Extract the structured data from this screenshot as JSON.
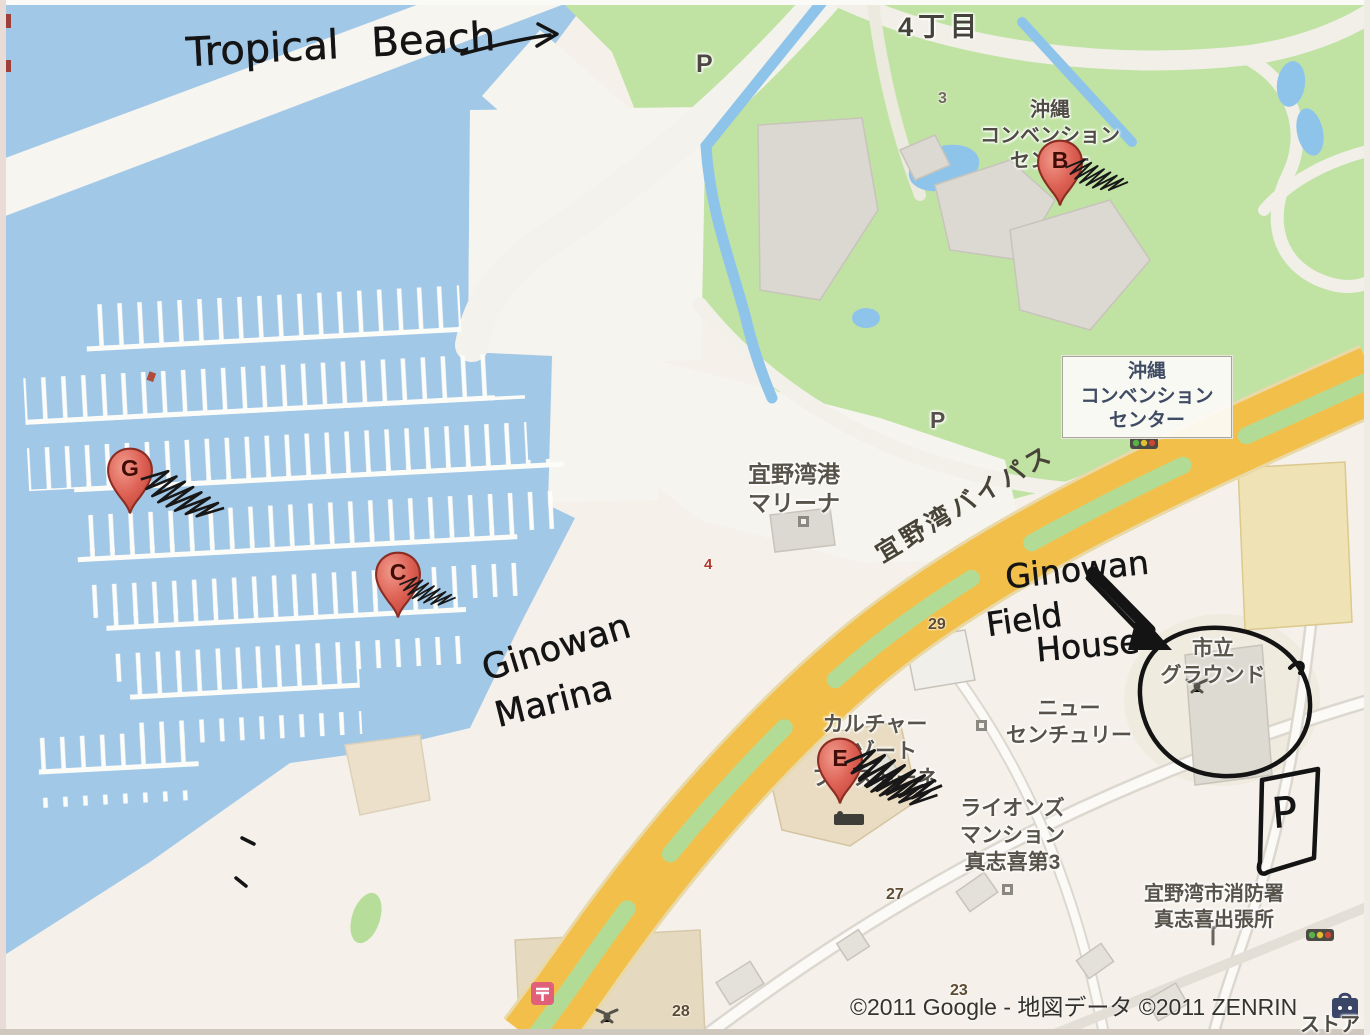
{
  "handwritten": {
    "tropical_beach": "Tropical Beach",
    "marina_line1": "Ginowan",
    "marina_line2": "Marina",
    "field_line1": "Ginowan",
    "field_line2": "Field",
    "field_line3": "House",
    "parking_box_letter": "P"
  },
  "markers": {
    "g": "G",
    "c": "C",
    "b": "B",
    "e": "E"
  },
  "labels": {
    "district_block": "4丁目",
    "convention_center_onmap": "沖縄\nコンベンション\nセンター",
    "convention_center_box": "沖縄\nコンベンション\nセンター",
    "ginowan_port_marina": "宜野湾港\nマリーナ",
    "ginowan_bypass": "宜野湾バイパス",
    "city_ground": "市立\nグラウンド",
    "new_century": "ニュー\nセンチュリー",
    "culture_resort_festone": "カルチャー\nリゾート\nフェストーネ",
    "lions_mansion": "ライオンズ\nマンション\n真志喜第3",
    "fire_station_branch": "宜野湾市消防署\n真志喜出張所",
    "store_partial": "ストア",
    "parking_north": "P",
    "parking_park": "P",
    "num_3": "3",
    "num_4": "4",
    "num_29": "29",
    "num_27": "27",
    "num_23": "23",
    "num_28": "28"
  },
  "copyright": "©2011 Google - 地図データ ©2011 ZENRIN",
  "icons": {
    "traffic_light": "traffic-light",
    "fire_station": "fire-station",
    "gym": "weightlifting-gym",
    "hotel": "hotel-bed",
    "post_office": "post-office",
    "store": "convenience-store",
    "building": "building-marker",
    "map_pin": "google-map-pin"
  },
  "colors": {
    "water": "#a2c8e8",
    "park_green": "#c0e3a3",
    "road_yellow": "#f2c04a",
    "road_median_green": "#b2dc96",
    "land": "#f5f1ea",
    "pin_red": "#dd6457",
    "ink": "#1a1a1a"
  }
}
